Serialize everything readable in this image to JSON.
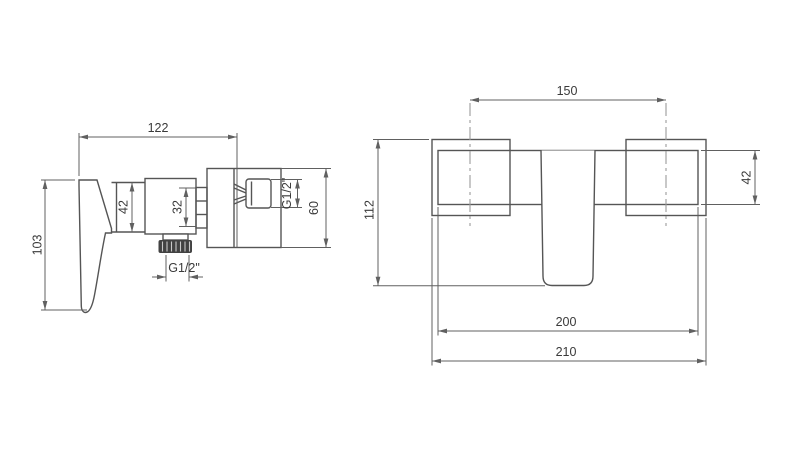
{
  "drawing": {
    "side": {
      "width": "122",
      "height": "103",
      "hub_height": "42",
      "cartridge": "32",
      "outlet_thread": "G1/2\"",
      "inlet_thread": "G1/2\"",
      "plate_height": "60"
    },
    "front": {
      "inlet_spacing": "150",
      "height": "112",
      "body_height": "42",
      "body_width": "200",
      "overall_width": "210"
    }
  },
  "colors": {
    "background": "#ffffff",
    "object_line": "#555555",
    "dimension_line": "#606060",
    "centerline": "#9a9a9a",
    "text": "#3a3a3a",
    "thread_fill": "#424242"
  }
}
